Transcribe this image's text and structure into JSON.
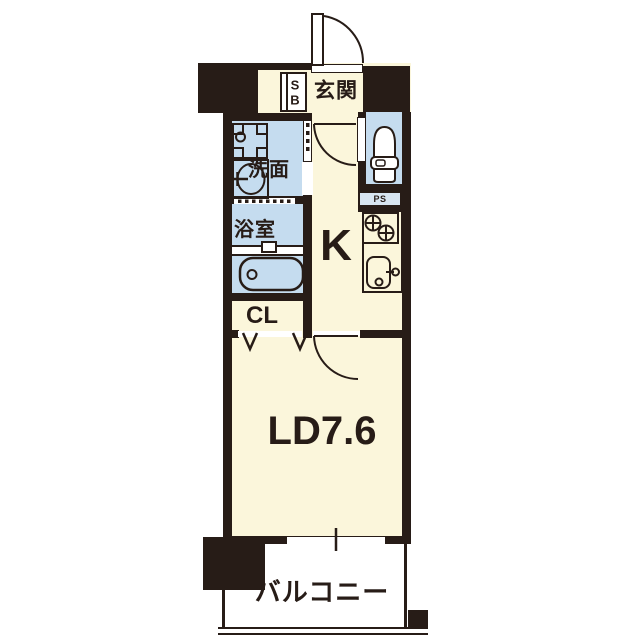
{
  "floorplan": {
    "labels": {
      "entrance": "玄関",
      "shoe_box_line1": "S",
      "shoe_box_line2": "B",
      "washroom": "洗面",
      "bathroom": "浴室",
      "kitchen": "K",
      "pipe_space": "PS",
      "closet": "CL",
      "living_dining": "LD7.6",
      "balcony": "バルコニー"
    },
    "colors": {
      "wall": "#271C17",
      "room_fill": "#FBF6DB",
      "wet_area_fill": "#C5DCEF",
      "pipe_space_fill": "#D8E5F1",
      "balcony_fill": "#FFFFFF"
    },
    "icons": [
      "entrance-door-swing-icon",
      "shoe-box-icon",
      "washing-machine-pan-icon",
      "wash-basin-icon",
      "bathtub-icon",
      "toilet-icon",
      "gas-stove-icon",
      "kitchen-sink-icon",
      "kitchen-door-swing-icon",
      "living-door-swing-icon",
      "folding-closet-door-icon",
      "sliding-window-icon"
    ]
  }
}
